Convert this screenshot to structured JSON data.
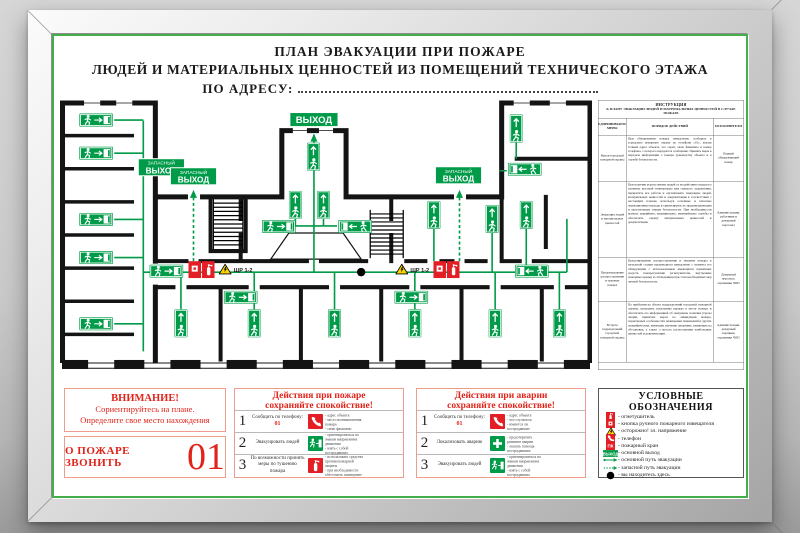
{
  "title": {
    "line1": "ПЛАН ЭВАКУАЦИИ ПРИ ПОЖАРЕ",
    "line2": "ЛЮДЕЙ И МАТЕРИАЛЬНЫХ ЦЕННОСТЕЙ ИЗ ПОМЕЩЕНИЙ ТЕХНИЧЕСКОГО ЭТАЖА",
    "line3": "ПО АДРЕСУ:"
  },
  "plan": {
    "exit_main": "ВЫХОД",
    "reserve_line1": "ЗАПАСНЫЙ",
    "reserve_line2": "ВЫХОД",
    "panel_label": "ЩР 1-2"
  },
  "instruction_table": {
    "header": "ИНСТРУКЦИЯ",
    "subheader": "К ПЛАНУ ЭВАКУАЦИИ ЛЮДЕЙ И МАТЕРИАЛЬНЫХ ЦЕННОСТЕЙ В СЛУЧАЕ ПОЖАРА",
    "col_measures": "ПРЕДПРИНИМАЕМЫЕ МЕРЫ",
    "col_actions": "ПОРЯДОК ДЕЙСТВИЙ",
    "col_executors": "ИСПОЛНИТЕЛИ",
    "rows": [
      {
        "measure": "Вызов городской пожарной охраны",
        "action": "При обнаружении пожара немедленно сообщить в городскую пожарную охрану по телефону «01», указав точный адрес объекта, что горит, свою фамилию и номер телефона, с которого передается сообщение. Принять меры к передаче информации о пожаре руководству объекта и в службу безопасности.",
        "executor": "Первый обнаруживший пожар"
      },
      {
        "measure": "Эвакуация людей и материальных ценностей",
        "action": "При наличии угрозы жизни людей от воздействия открытого пламени, высокой температуры или сильного задымления, прекратить все работы и организовать эвакуацию людей, материальных ценностей и документации в соответствии с настоящим планом, используя основные и запасные эвакуационные выходы и ориентируясь по предписывающим и указательным знакам безопасности. При необходимости вызвать аварийную, медицинскую, милицейскую службы и обеспечить охрану материальных ценностей и документации.",
        "executor": "Администрация, работники и дежурный персонал"
      },
      {
        "measure": "Предотвращение распространения и тушение пожара",
        "action": "Предотвращение распространения и тушение пожара в начальной стадии производится немедленно с момента его обнаружения с использованием имеющихся первичных средств пожаротушения (огнетушители, внутренние пожарные краны) и соблюдением при этом необходимых мер личной безопасности.",
        "executor": "Дежурный персонал, охранники ЧОП"
      },
      {
        "measure": "Встреча подразделений городской пожарной охраны",
        "action": "По прибытии на объект подразделений городской пожарной охраны, проводить начальника караула к месту пожара и обеспечить его информацией об эвакуации, наличии угрозы людям, принятых мерах по ликвидации пожара, характерных особенностях планировки помещений и других специфических, имеющих значение сведениях, влияющих на обстановку, а также о местах расположения наибольших ценностей и документации.",
        "executor": "Администрация, дежурный охранник, охранники ЧОП"
      }
    ]
  },
  "attention": {
    "title": "ВНИМАНИЕ!",
    "line1": "Сориентируйтесь на плане.",
    "line2": "Определите свое место  нахождения"
  },
  "fire_call": {
    "label": "О ПОЖАРЕ ЗВОНИТЬ",
    "number": "01"
  },
  "fire_actions": {
    "title": "Действия при пожаре",
    "subtitle": "сохраняйте спокойствие!",
    "rows": [
      {
        "num": "1",
        "action": "Сообщить по телефону:",
        "accent": "01",
        "bullets": [
          "адрес объекта",
          "место возникновения пожара",
          "свою фамилию"
        ]
      },
      {
        "num": "2",
        "action": "Эвакуировать людей",
        "accent": "",
        "bullets": [
          "ориентироваться по знакам направления движения",
          "взять с собой пострадавших"
        ]
      },
      {
        "num": "3",
        "action": "По возможности принять меры по тушению пожара",
        "accent": "",
        "bullets": [
          "использовать средства противопожарной защиты",
          "при необходимости обесточить помещение"
        ]
      }
    ]
  },
  "accident_actions": {
    "title": "Действия при аварии",
    "subtitle": "сохраняйте спокойствие!",
    "rows": [
      {
        "num": "1",
        "action": "Сообщить по телефону:",
        "accent": "01",
        "bullets": [
          "адрес объекта",
          "что случилось",
          "имеются ли пострадавшие"
        ]
      },
      {
        "num": "2",
        "action": "Локализовать аварию",
        "accent": "",
        "bullets": [
          "предотвратить развитие аварии",
          "оказать помощь пострадавшим"
        ]
      },
      {
        "num": "3",
        "action": "Эвакуировать людей",
        "accent": "",
        "bullets": [
          "ориентироваться по знакам направления движения",
          "взять с собой пострадавших"
        ]
      }
    ]
  },
  "legend": {
    "title": "УСЛОВНЫЕ ОБОЗНАЧЕНИЯ",
    "exit_chip": "ВЫХОД",
    "pk": "ПК",
    "items": [
      "огнетушитель",
      "кнопка ручного пожарного извещателя",
      "осторожно! эл. напряжение",
      "телефон",
      "пожарный кран",
      "основной выход",
      "основной путь эвакуации",
      "запасной путь эвакуации",
      "вы находитесь здесь"
    ]
  },
  "colors": {
    "green": "#009b48",
    "red": "#e31e24",
    "yellow": "#ffd500"
  }
}
